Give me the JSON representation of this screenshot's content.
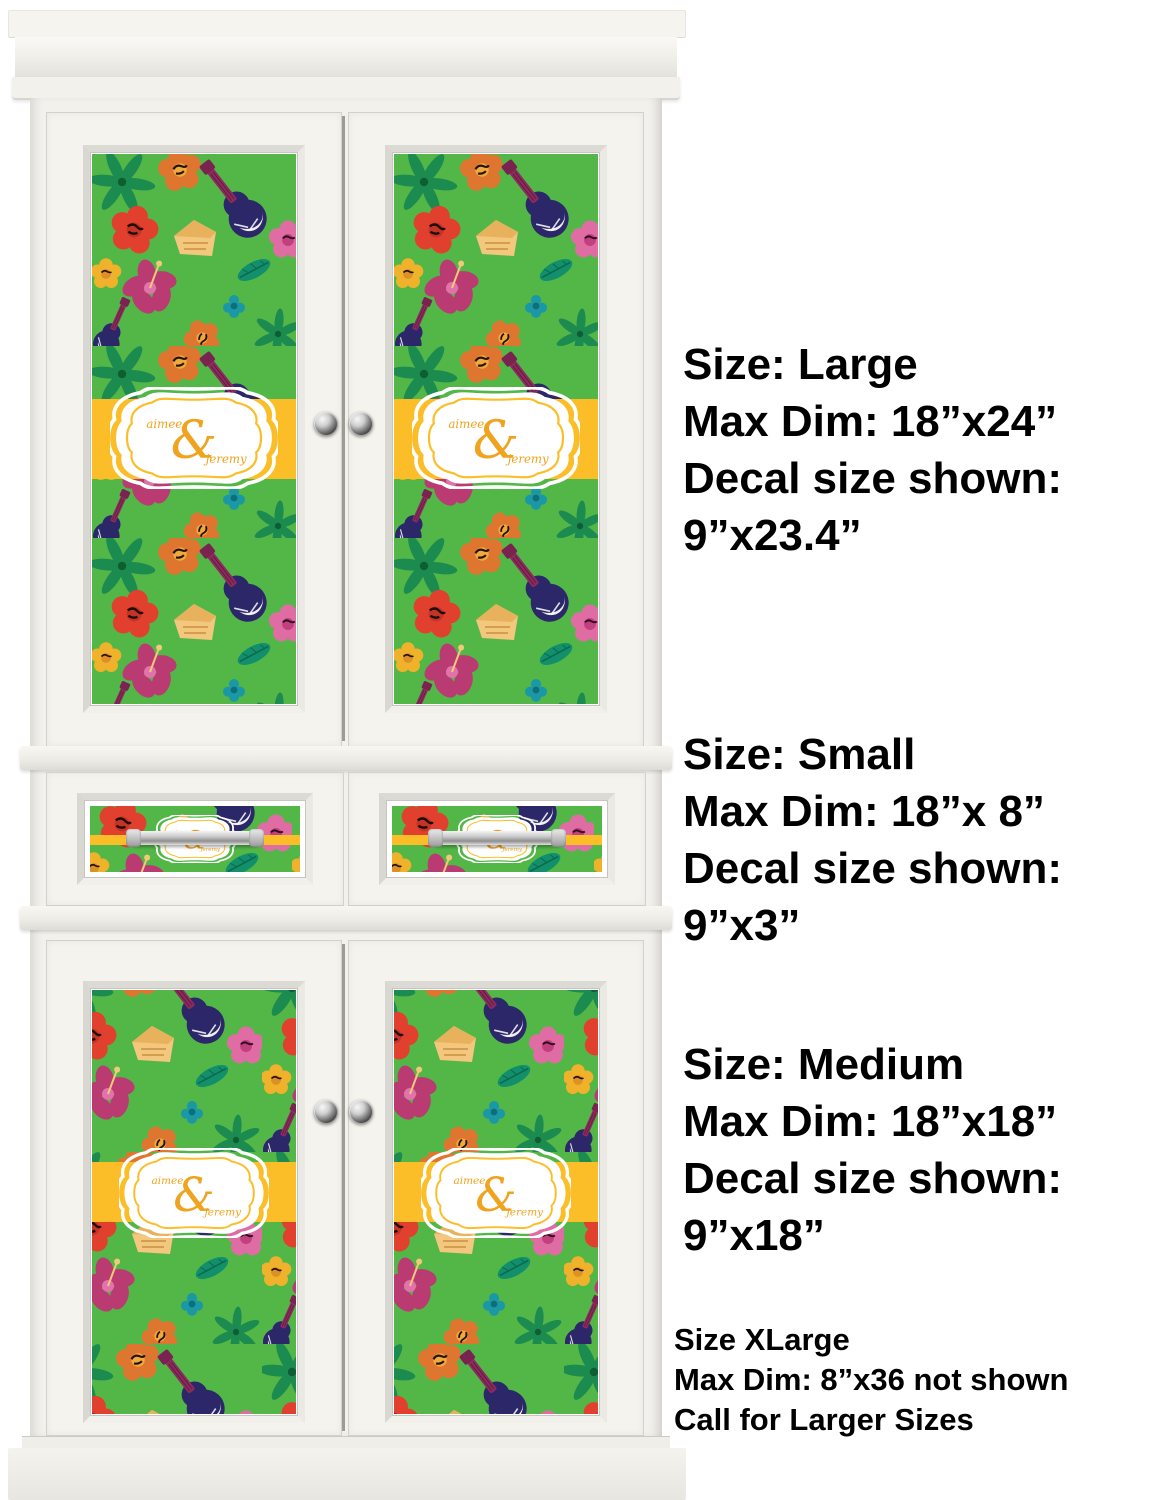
{
  "illustration": {
    "description": "white armoire cabinet shown with personalized luau-pattern decals applied",
    "badge": {
      "first_name": "aimee",
      "ampersand": "&",
      "second_name": "jeremy"
    },
    "colors": {
      "pattern_green": "#53B748",
      "band_yellow": "#FBBE28",
      "badge_text_yellow": "#F0A31F",
      "cabinet_white": "#F2F1EC",
      "pattern_navy": "#2B2768",
      "pattern_maroon": "#8E2A5E",
      "pattern_pink": "#E06CA4",
      "pattern_orange": "#DE7630",
      "pattern_red": "#E2402E",
      "pattern_teal": "#12906C",
      "pattern_palm_green": "#1C8B50",
      "pattern_tan": "#F3C77E",
      "annotation_text": "#000000"
    }
  },
  "annotations": {
    "large": {
      "line1": "Size: Large",
      "line2": "Max Dim: 18”x24”",
      "line3": "Decal size shown:",
      "line4": "9”x23.4”"
    },
    "small": {
      "line1": "Size: Small",
      "line2": "Max Dim: 18”x 8”",
      "line3": "Decal size shown:",
      "line4": "9”x3”"
    },
    "medium": {
      "line1": "Size: Medium",
      "line2": "Max Dim: 18”x18”",
      "line3": "Decal size shown:",
      "line4": "9”x18”"
    },
    "xlarge": {
      "line1": "Size XLarge",
      "line2": "Max Dim: 8”x36 not shown",
      "line3": "Call for Larger Sizes"
    }
  }
}
